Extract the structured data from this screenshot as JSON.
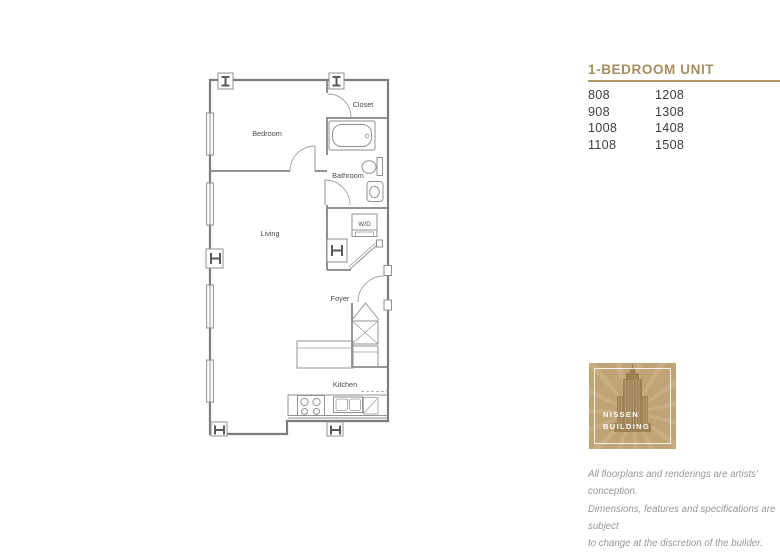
{
  "header": {
    "title": "1-BEDROOM UNIT"
  },
  "units": {
    "rows": [
      [
        "808",
        "1208"
      ],
      [
        "908",
        "1308"
      ],
      [
        "1008",
        "1408"
      ],
      [
        "1108",
        "1508"
      ]
    ]
  },
  "floorplan": {
    "labels": {
      "bedroom": "Bedroom",
      "closet": "Closet",
      "bathroom": "Bathroom",
      "living": "Living",
      "wd": "W/D",
      "foyer": "Foyer",
      "kitchen": "Kitchen"
    }
  },
  "logo": {
    "name_line1": "NISSEN",
    "name_line2": "BUILDING"
  },
  "disclaimer": {
    "line1": "All floorplans and renderings are artists' conception.",
    "line2": "Dimensions, features and specifications are subject",
    "line3": "to change at the discretion of the builder."
  },
  "colors": {
    "gold_text": "#a78e5f",
    "gold_rule": "#ae9668",
    "logo_gold": "#c1a475",
    "logo_building": "#9a7c4e",
    "plan_wall": "#7d7d7d",
    "plan_label": "#4a4a4a",
    "unit_text": "#3d3d3d",
    "disclaimer_text": "#97979a"
  }
}
